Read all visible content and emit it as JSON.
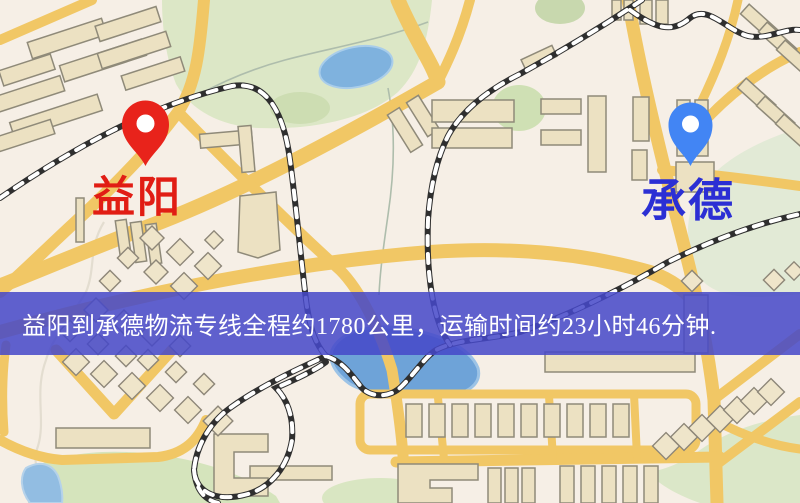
{
  "map": {
    "origin_label": "益阳",
    "dest_label": "承德",
    "banner_text": "益阳到承德物流专线全程约1780公里，运输时间约23小时46分钟.",
    "route_summary": {
      "origin": "益阳",
      "destination": "承德",
      "distance": "约1780公里",
      "duration": "约23小时46分钟"
    },
    "icons": {
      "origin_pin": "origin-pin-icon",
      "dest_pin": "dest-pin-icon"
    },
    "colors": {
      "banner": "#4648c8",
      "origin_pin": "#e8231b",
      "origin_text": "#e11d14",
      "dest_pin": "#4285f4",
      "dest_text": "#2b2fd4",
      "road": "#f1c765",
      "park": "#dce7c6",
      "water": "#7fb2de",
      "building": "#ece1c2",
      "railway": "#2f2f2f",
      "background": "#f6efe6"
    }
  }
}
